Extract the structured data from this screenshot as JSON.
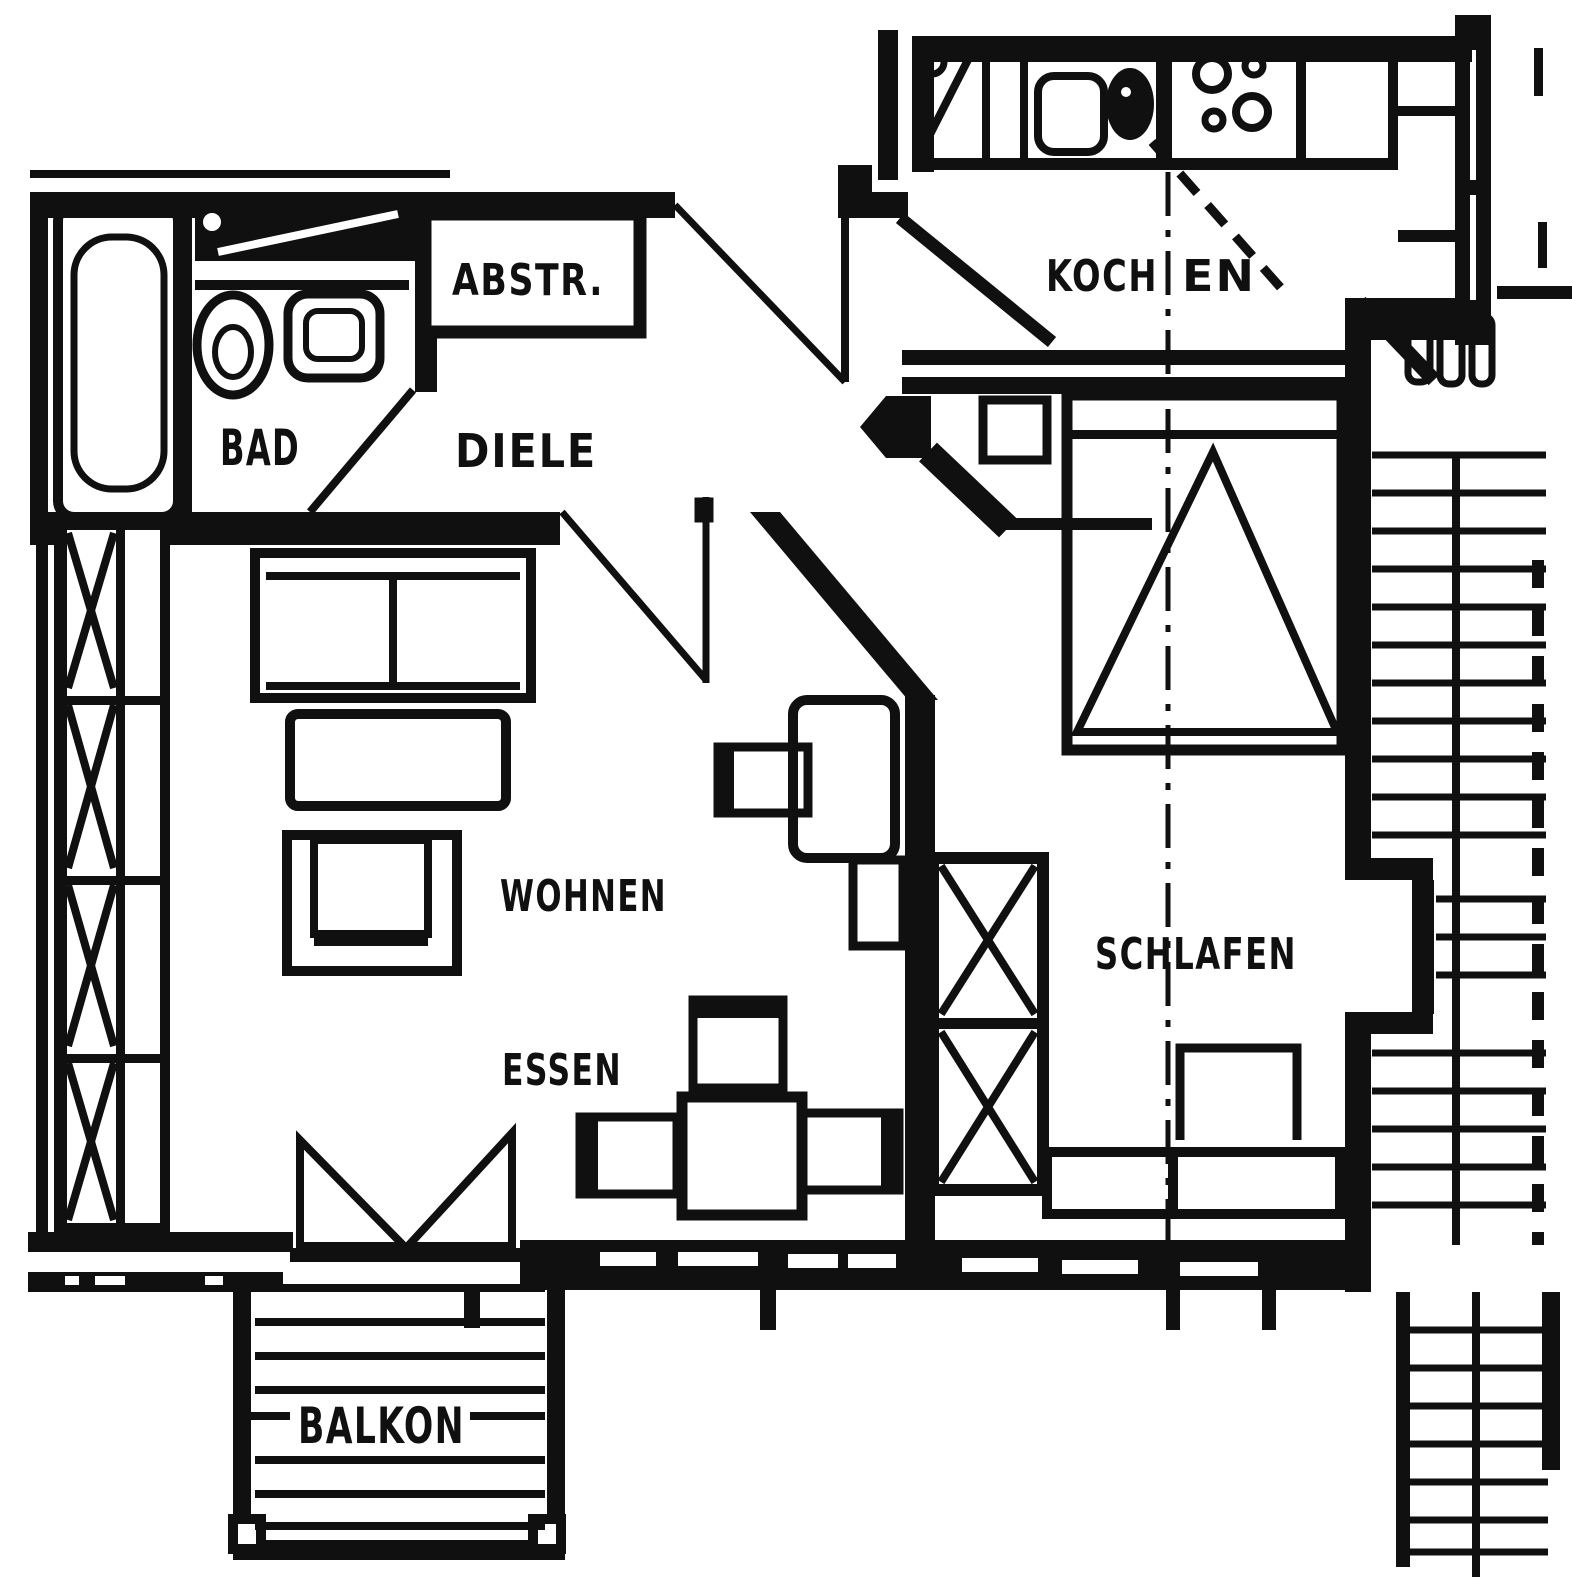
{
  "document": {
    "type": "scanned-apartment-floor-plan"
  },
  "colors": {
    "ink": "#101010",
    "paper": "#ffffff"
  },
  "rooms": {
    "bad": {
      "label": "BAD",
      "fixtures": [
        "bathtub",
        "toilet",
        "washbasin",
        "washing-machine"
      ]
    },
    "abstellraum": {
      "label": "ABSTR."
    },
    "diele": {
      "label": "DIELE"
    },
    "kochen": {
      "label_left": "KOCH",
      "label_right": "EN",
      "fixtures": [
        "refrigerator",
        "kitchen-sink",
        "stove",
        "counter"
      ]
    },
    "wohnen": {
      "label": "WOHNEN",
      "furniture": [
        "sofa",
        "coffee-table",
        "armchair",
        "shelf-unit",
        "desk",
        "desk-chair",
        "wall-shelf"
      ]
    },
    "essen": {
      "label": "ESSEN",
      "furniture": [
        "dining-table",
        "dining-chairs"
      ]
    },
    "schlafen": {
      "label": "SCHLAFEN",
      "furniture": [
        "double-bed",
        "nightstand",
        "wardrobe",
        "sideboard"
      ]
    },
    "balkon": {
      "label": "BALKON"
    }
  },
  "exterior": {
    "stairwell": "stair-treads",
    "window_band": "x-lattice"
  }
}
